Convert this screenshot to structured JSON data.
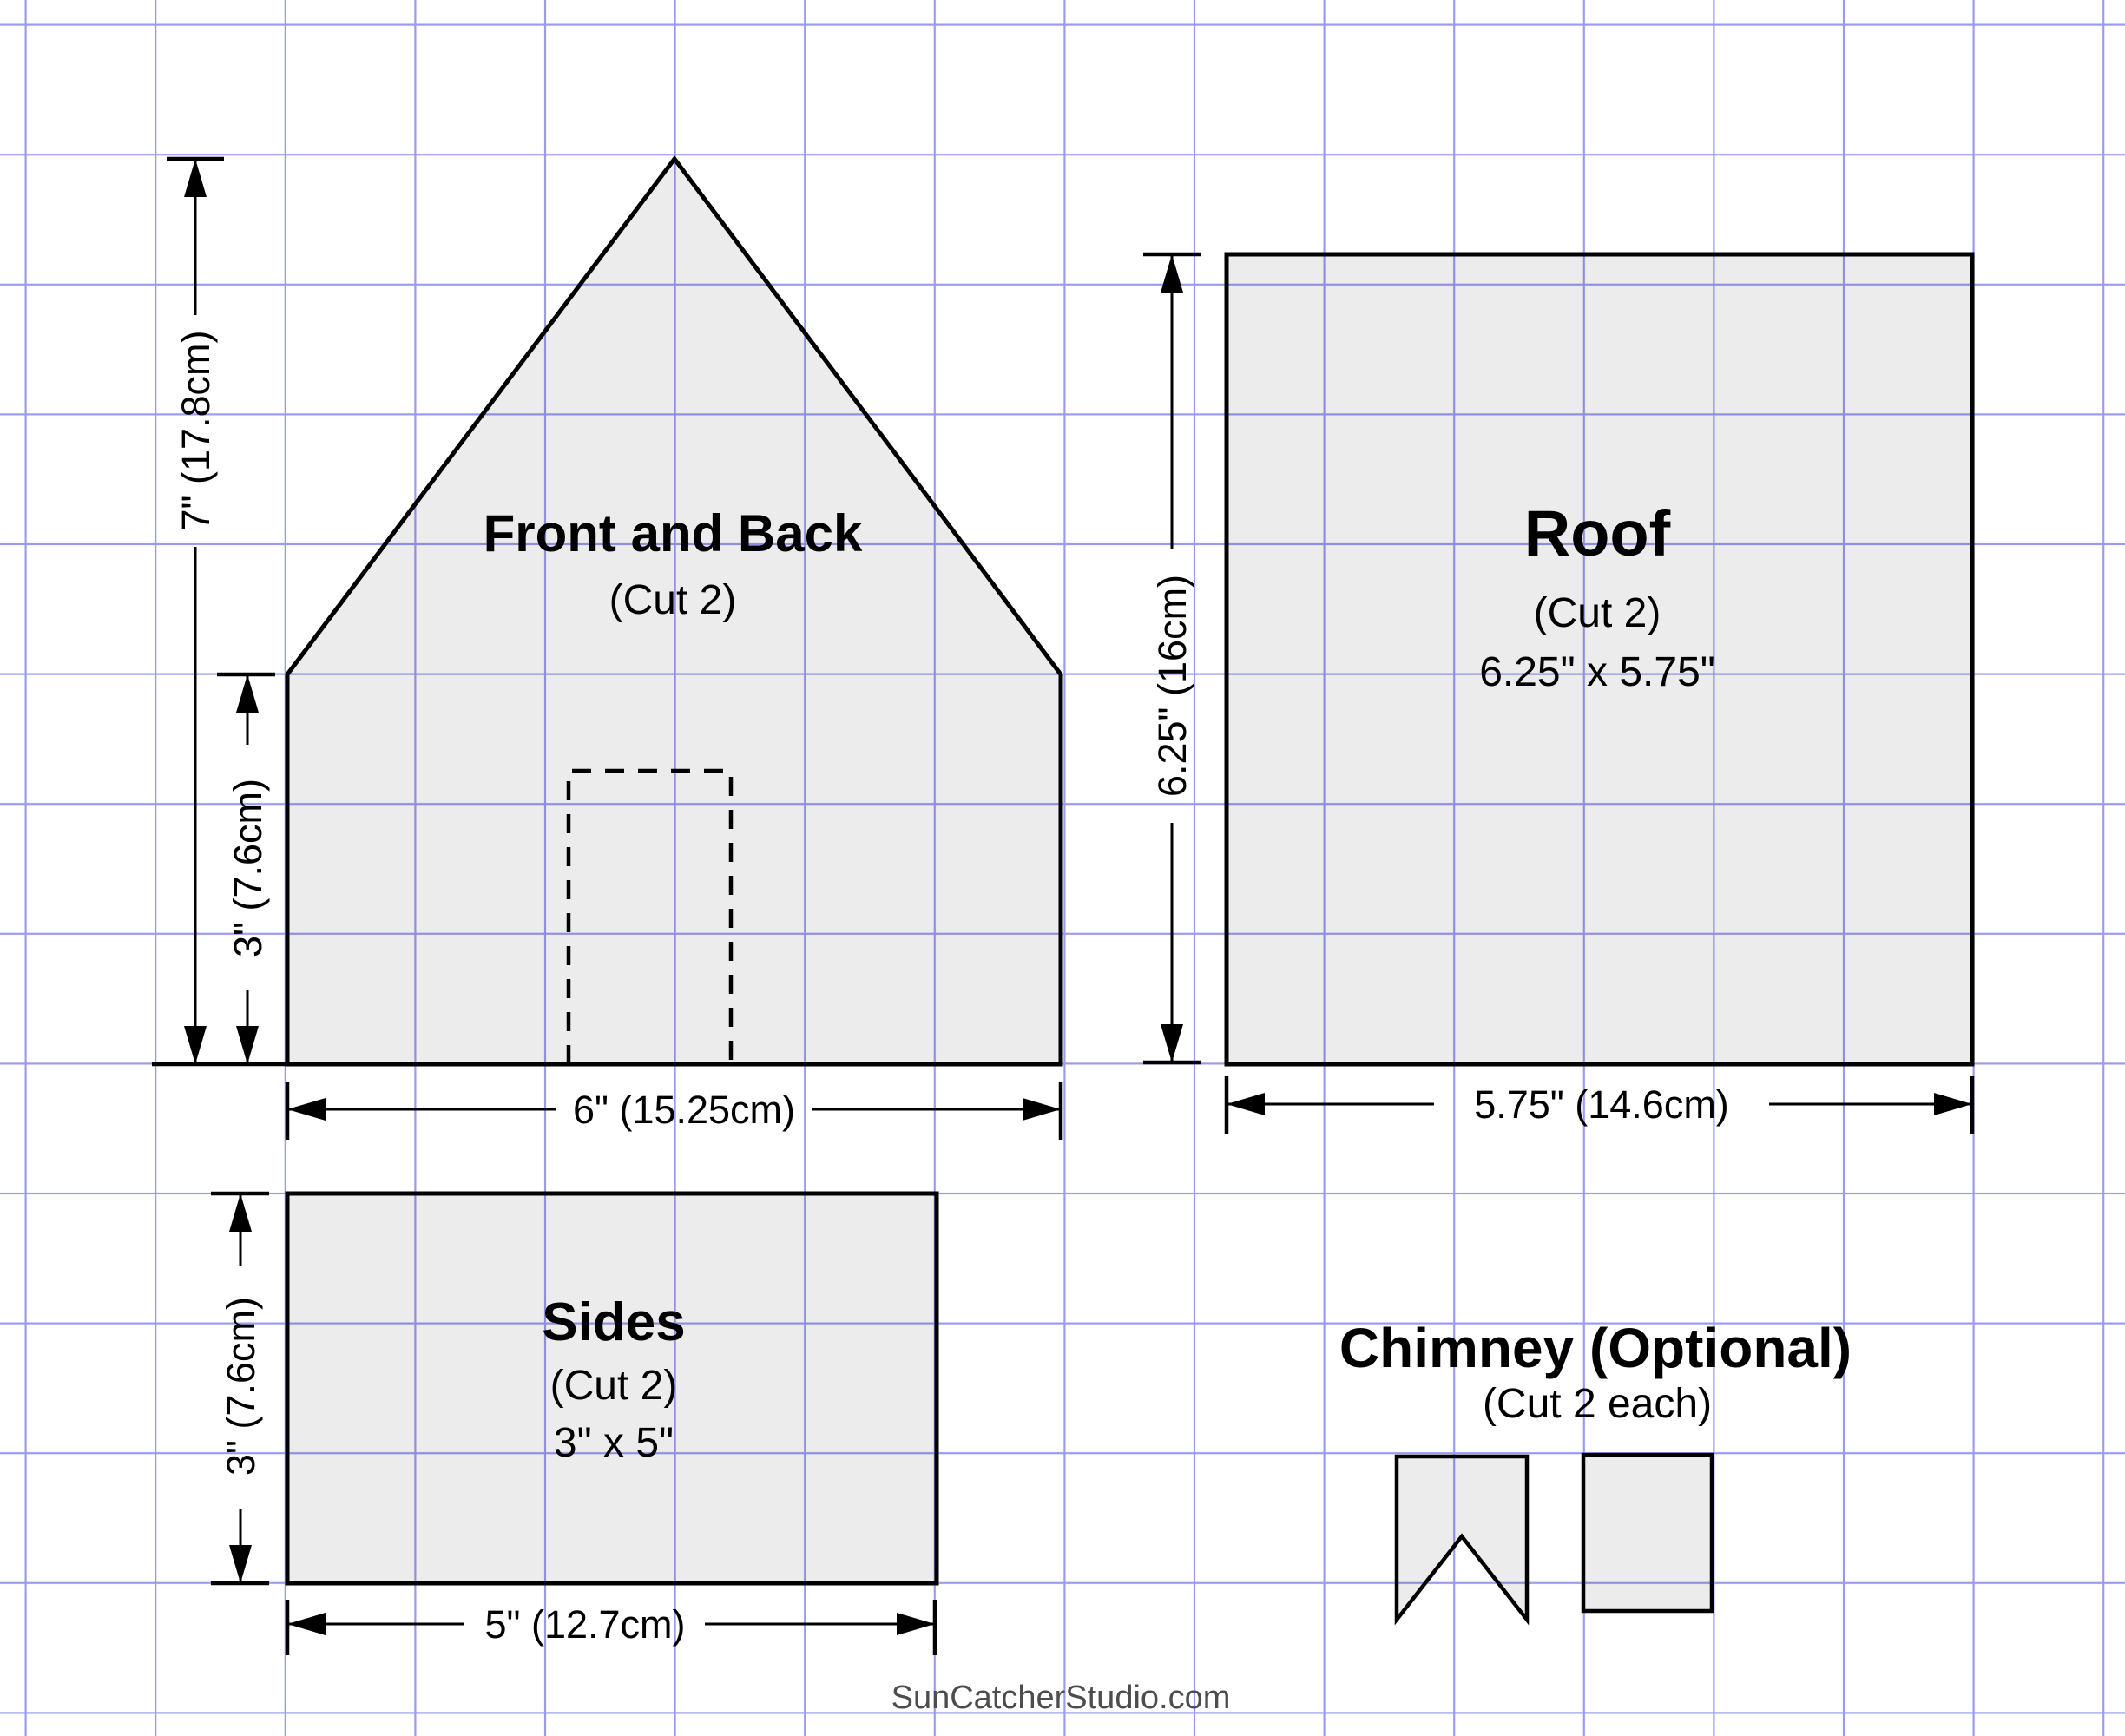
{
  "sheet": {
    "watermark": "SunCatcherStudio.com"
  },
  "colors": {
    "background": "#ffffff",
    "grid": "#9a9af0",
    "outline": "#000000",
    "piece_fill": "#ececec",
    "watermark_text": "#4d4d4d"
  },
  "grid": {
    "spacing_px": "149.6",
    "square_size": "1 inch"
  },
  "pieces": {
    "front_back": {
      "title": "Front and Back",
      "subtitle": "(Cut 2)"
    },
    "roof": {
      "title": "Roof",
      "subtitle": "(Cut 2)",
      "size": "6.25\" x 5.75\""
    },
    "sides": {
      "title": "Sides",
      "subtitle": "(Cut 2)",
      "size": "3\" x 5\""
    },
    "chimney": {
      "title": "Chimney (Optional)",
      "subtitle": "(Cut 2 each)"
    }
  },
  "dimensions": {
    "front_back_height": "7\" (17.8cm)",
    "front_back_wall_height": "3\" (7.6cm)",
    "front_back_width": "6\" (15.25cm)",
    "roof_height": "6.25\" (16cm)",
    "roof_width": "5.75\" (14.6cm)",
    "sides_height": "3\" (7.6cm)",
    "sides_width": "5\" (12.7cm)"
  }
}
